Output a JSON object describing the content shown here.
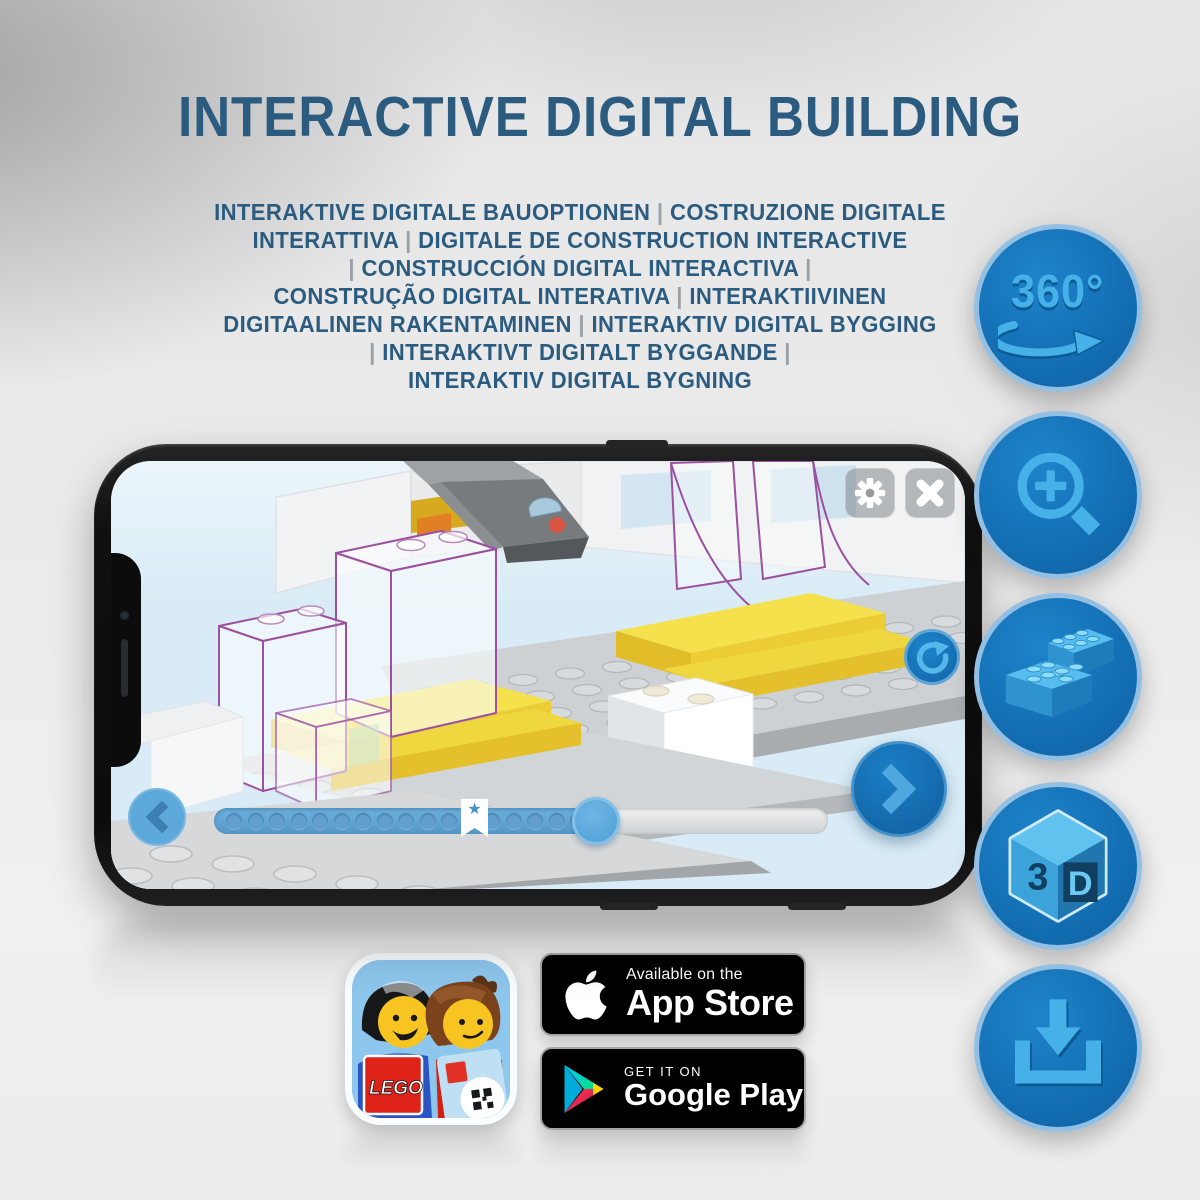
{
  "title": "INTERACTIVE DIGITAL BUILDING",
  "subtitle_lines": [
    "INTERAKTIVE DIGITALE BAUOPTIONEN | COSTRUZIONE DIGITALE",
    "INTERATTIVA | DIGITALE DE CONSTRUCTION INTERACTIVE",
    "| CONSTRUCCIÓN DIGITAL INTERACTIVA |",
    "CONSTRUÇÃO DIGITAL INTERATIVA | INTERAKTIIVINEN",
    "DIGITAALINEN RAKENTAMINEN | INTERAKTIV DIGITAL BYGGING",
    "| INTERAKTIVT DIGITALT BYGGANDE |",
    "INTERAKTIV DIGITAL BYGNING"
  ],
  "feature_badges": {
    "rotation_label": "360°",
    "cube_left": "3",
    "cube_right": "D",
    "icons": [
      "360-rotation-icon",
      "zoom-in-icon",
      "lego-bricks-icon",
      "3d-cube-icon",
      "download-icon"
    ]
  },
  "phone_app": {
    "progress_dots": 17,
    "bookmark_star": "★",
    "icons": [
      "gear-icon",
      "close-icon",
      "rotate-icon",
      "next-arrow-icon",
      "back-arrow-icon"
    ]
  },
  "store_badges": {
    "app_store": {
      "tagline": "Available on the",
      "store": "App Store"
    },
    "google_play": {
      "tagline": "GET IT ON",
      "store": "Google Play"
    }
  },
  "app_icon": {
    "logo_text": "LEGO"
  },
  "colors": {
    "title_blue": "#2B5C80",
    "circle_blue": "#1470B5",
    "glyph_blue": "#45B1E8",
    "lego_yellow": "#F2DE45",
    "ghost_purple": "#9C50A0",
    "screen_blue": "#D8EBF6"
  }
}
